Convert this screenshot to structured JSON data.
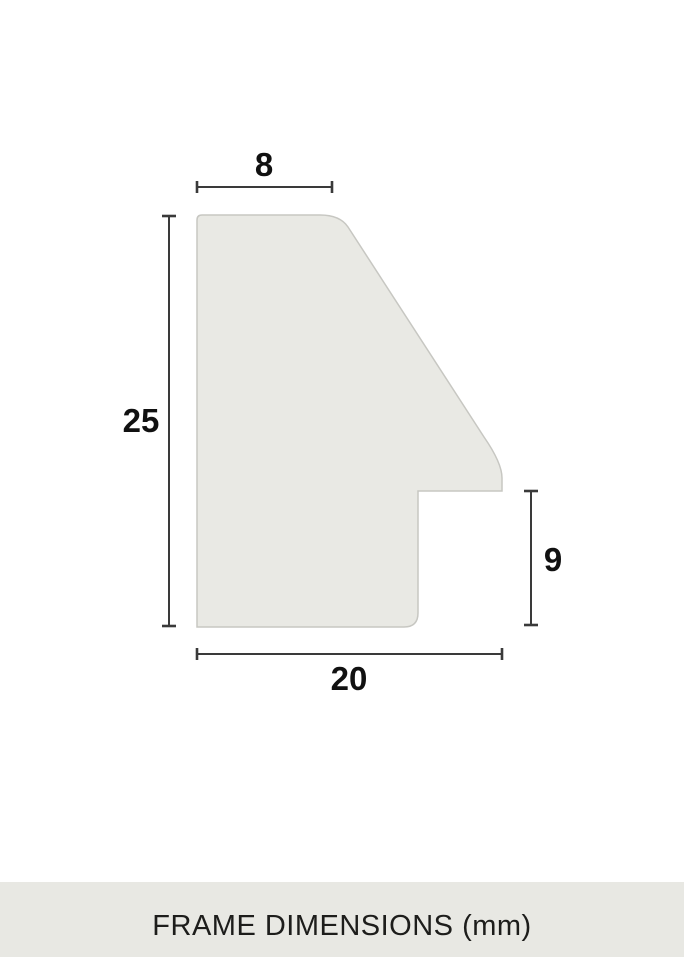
{
  "diagram": {
    "title": "FRAME DIMENSIONS (mm)",
    "unit": "mm",
    "subject": "picture-frame moulding profile cross-section",
    "dimensions": {
      "top_width": "8",
      "profile_height": "25",
      "rabbet_height": "9",
      "profile_width": "20"
    },
    "colors": {
      "background": "#ffffff",
      "profile_fill": "#e9e9e4",
      "profile_stroke": "#c7c7c2",
      "dimension_line": "#3a3a3a",
      "label_text": "#111111",
      "footer_background": "#e8e8e3",
      "footer_text": "#1d1d1b"
    }
  }
}
